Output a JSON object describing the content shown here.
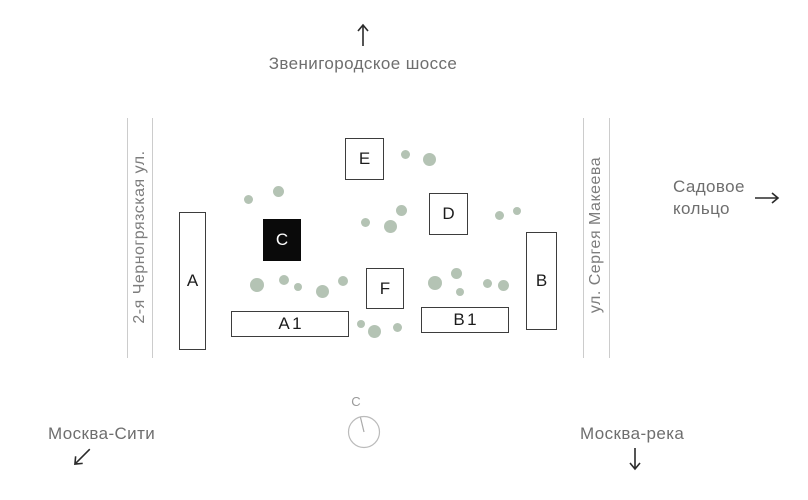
{
  "labels": {
    "top_road": "Звенигородское шоссе",
    "left_street": "2-я Черногрязская ул.",
    "right_street": "ул. Сергея Макеева",
    "sadovoe_line1": "Садовое",
    "sadovoe_line2": "кольцо",
    "moscow_city": "Москва-Сити",
    "moscow_river": "Москва-река",
    "compass_north": "С"
  },
  "icons": {
    "top_road_arrow": "arrow-up",
    "sadovoe_arrow": "arrow-right",
    "moscow_city_arrow": "arrow-down-left",
    "moscow_river_arrow": "arrow-down",
    "compass": "compass-dial"
  },
  "buildings": [
    {
      "id": "building-a",
      "label": "A",
      "x": 179,
      "y": 212,
      "w": 27,
      "h": 138,
      "highlighted": false
    },
    {
      "id": "building-c",
      "label": "C",
      "x": 263,
      "y": 219,
      "w": 38,
      "h": 42,
      "highlighted": true
    },
    {
      "id": "building-e",
      "label": "E",
      "x": 345,
      "y": 138,
      "w": 39,
      "h": 42,
      "highlighted": false
    },
    {
      "id": "building-d",
      "label": "D",
      "x": 429,
      "y": 193,
      "w": 39,
      "h": 42,
      "highlighted": false
    },
    {
      "id": "building-f",
      "label": "F",
      "x": 366,
      "y": 268,
      "w": 38,
      "h": 41,
      "highlighted": false
    },
    {
      "id": "building-b",
      "label": "B",
      "x": 526,
      "y": 232,
      "w": 31,
      "h": 98,
      "highlighted": false
    },
    {
      "id": "building-a1",
      "label": "A1",
      "x": 231,
      "y": 311,
      "w": 118,
      "h": 26,
      "highlighted": false
    },
    {
      "id": "building-b1",
      "label": "B1",
      "x": 421,
      "y": 307,
      "w": 88,
      "h": 26,
      "highlighted": false
    }
  ],
  "trees": [
    [
      248,
      199,
      4.5
    ],
    [
      278,
      191,
      5.5
    ],
    [
      405,
      154,
      4.5
    ],
    [
      429,
      159,
      6.5
    ],
    [
      365,
      222,
      4.5
    ],
    [
      390,
      226,
      6.5
    ],
    [
      401,
      210,
      5.5
    ],
    [
      499,
      215,
      4.5
    ],
    [
      517,
      211,
      4
    ],
    [
      257,
      285,
      7
    ],
    [
      284,
      280,
      5
    ],
    [
      298,
      287,
      4
    ],
    [
      322,
      291,
      6.5
    ],
    [
      343,
      281,
      5
    ],
    [
      435,
      283,
      7
    ],
    [
      456,
      273,
      5.5
    ],
    [
      460,
      292,
      4
    ],
    [
      487,
      283,
      4.5
    ],
    [
      503,
      285,
      5.5
    ],
    [
      361,
      324,
      4
    ],
    [
      374,
      331,
      6.5
    ],
    [
      397,
      327,
      4.5
    ]
  ],
  "colors": {
    "background": "#ffffff",
    "tree": "#b4c3b4",
    "road_line": "#cccccc",
    "street_text": "#7d7d7d",
    "label_text": "#6e6e6e",
    "building_border": "#3d3d3d",
    "highlight_fill": "#0a0a0a",
    "arrow": "#2b2b2b",
    "compass": "#aaaaaa"
  },
  "roads": {
    "left": {
      "x1": 127,
      "x2": 152,
      "y_top": 118,
      "y_bottom": 358
    },
    "right": {
      "x1": 583,
      "x2": 609,
      "y_top": 118,
      "y_bottom": 358
    }
  }
}
